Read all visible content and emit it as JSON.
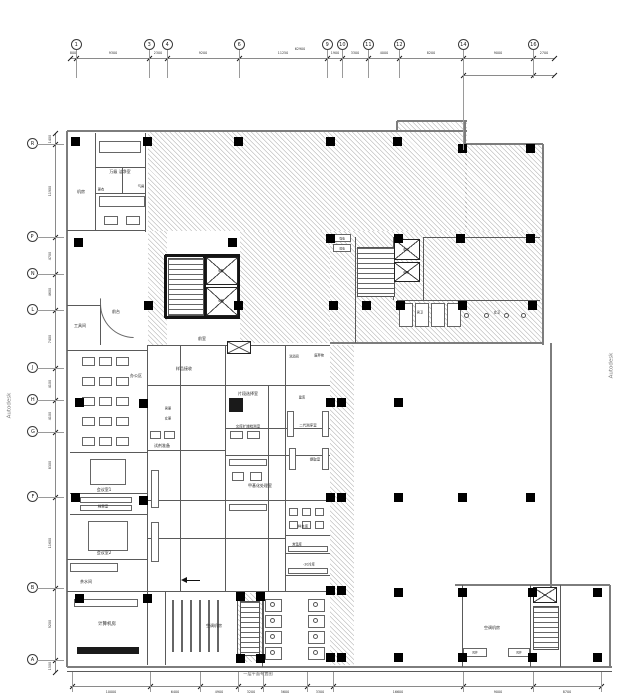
{
  "meta": {
    "watermark": "Autodesk",
    "caption": "一层平面布置图",
    "palette": {
      "wall": "#7d7d7d",
      "partition": "#5a5a5a",
      "core_wall": "#141414",
      "column": "#000000",
      "hatch": "rgba(55,55,55,0.30)",
      "background": "#ffffff"
    }
  },
  "grid": {
    "top": {
      "bubble_y": 45,
      "line_y": 58,
      "x0": 70,
      "x1": 554,
      "bubbles": [
        {
          "l": "1",
          "x": 76
        },
        {
          "l": "3",
          "x": 149
        },
        {
          "l": "4",
          "x": 167
        },
        {
          "l": "6",
          "x": 239
        },
        {
          "l": "9",
          "x": 327
        },
        {
          "l": "10",
          "x": 342
        },
        {
          "l": "11",
          "x": 368
        },
        {
          "l": "12",
          "x": 399
        },
        {
          "l": "14",
          "x": 463
        },
        {
          "l": "16",
          "x": 533
        }
      ],
      "ticks": [
        70,
        76,
        149,
        167,
        239,
        327,
        342,
        368,
        399,
        463,
        533,
        554
      ],
      "dims": [
        "800",
        "9300",
        "2300",
        "9200",
        "11250",
        "1900",
        "3300",
        "4000",
        "8200",
        "9000",
        "2700"
      ],
      "sub_line": {
        "y": 75,
        "ticks": [
          463,
          533,
          554
        ]
      },
      "overall": {
        "t": "62900",
        "x": 300,
        "y": 49
      }
    },
    "left": {
      "bubble_x": 32,
      "line_x": 55,
      "y0": 133,
      "y1": 672,
      "bubbles": [
        {
          "l": "R",
          "y": 144
        },
        {
          "l": "P",
          "y": 237
        },
        {
          "l": "N",
          "y": 274
        },
        {
          "l": "L",
          "y": 310
        },
        {
          "l": "J",
          "y": 368
        },
        {
          "l": "H",
          "y": 400
        },
        {
          "l": "G",
          "y": 432
        },
        {
          "l": "F",
          "y": 497
        },
        {
          "l": "B",
          "y": 588
        },
        {
          "l": "A",
          "y": 660
        }
      ],
      "ticks": [
        133,
        144,
        237,
        274,
        310,
        368,
        400,
        432,
        497,
        588,
        660,
        672
      ],
      "dims": [
        "1400",
        "11900",
        "4700",
        "4600",
        "7400",
        "4100",
        "4100",
        "8300",
        "11600",
        "9200",
        "1500"
      ]
    },
    "bottom": {
      "line_y": 686,
      "x0": 70,
      "x1": 601,
      "ticks": [
        72,
        150,
        200,
        238,
        263,
        307,
        333,
        463,
        533,
        601
      ],
      "dims": [
        "10000",
        "6400",
        "4900",
        "3200",
        "5600",
        "3300",
        "16600",
        "9000",
        "8700"
      ]
    }
  },
  "rooms": {
    "labels": [
      {
        "t": "机房",
        "x": 81,
        "y": 191,
        "fs": 4
      },
      {
        "t": "万级 洁净室",
        "x": 120,
        "y": 171,
        "fs": 4
      },
      {
        "t": "气闸",
        "x": 141,
        "y": 186,
        "fs": 3.2
      },
      {
        "t": "更衣",
        "x": 101,
        "y": 189,
        "fs": 3.2
      },
      {
        "t": "工具间",
        "x": 80,
        "y": 325,
        "fs": 4
      },
      {
        "t": "前台",
        "x": 116,
        "y": 311,
        "fs": 4
      },
      {
        "t": "办公区",
        "x": 136,
        "y": 375,
        "fs": 4
      },
      {
        "t": "会议室1",
        "x": 104,
        "y": 489,
        "fs": 4
      },
      {
        "t": "档案室",
        "x": 103,
        "y": 506,
        "fs": 3.5
      },
      {
        "t": "会议室2",
        "x": 104,
        "y": 552,
        "fs": 4
      },
      {
        "t": "茶水间",
        "x": 86,
        "y": 581,
        "fs": 4
      },
      {
        "t": "计算机房",
        "x": 107,
        "y": 623,
        "fs": 4.5
      },
      {
        "t": "样品接收",
        "x": 184,
        "y": 368,
        "fs": 4
      },
      {
        "t": "男更",
        "x": 168,
        "y": 408,
        "fs": 3.2
      },
      {
        "t": "女更",
        "x": 168,
        "y": 418,
        "fs": 3.2
      },
      {
        "t": "试剂准备",
        "x": 162,
        "y": 445,
        "fs": 4
      },
      {
        "t": "片段选择室",
        "x": 248,
        "y": 393,
        "fs": 4
      },
      {
        "t": "文库扩增检测室",
        "x": 248,
        "y": 426,
        "fs": 3.5
      },
      {
        "t": "甲基化处理室",
        "x": 260,
        "y": 485,
        "fs": 4
      },
      {
        "t": "洗消间",
        "x": 294,
        "y": 356,
        "fs": 3.2
      },
      {
        "t": "废弃物",
        "x": 319,
        "y": 355,
        "fs": 3.2
      },
      {
        "t": "建库",
        "x": 302,
        "y": 397,
        "fs": 3.2
      },
      {
        "t": "二代测序室",
        "x": 308,
        "y": 425,
        "fs": 3.5
      },
      {
        "t": "提取室",
        "x": 315,
        "y": 459,
        "fs": 3.5
      },
      {
        "t": "样本库",
        "x": 303,
        "y": 526,
        "fs": 3.5
      },
      {
        "t": "常温库",
        "x": 297,
        "y": 544,
        "fs": 3.2
      },
      {
        "t": "-20冷库",
        "x": 309,
        "y": 564,
        "fs": 3.2
      },
      {
        "t": "前室",
        "x": 202,
        "y": 338,
        "fs": 4
      },
      {
        "t": "电梯",
        "x": 221,
        "y": 270,
        "fs": 3
      },
      {
        "t": "电梯",
        "x": 221,
        "y": 300,
        "fs": 3
      },
      {
        "t": "电梯",
        "x": 406,
        "y": 249,
        "fs": 3
      },
      {
        "t": "电梯",
        "x": 406,
        "y": 272,
        "fs": 3
      },
      {
        "t": "男卫",
        "x": 420,
        "y": 312,
        "fs": 3.2
      },
      {
        "t": "女卫",
        "x": 497,
        "y": 312,
        "fs": 3.2
      },
      {
        "t": "强电",
        "x": 342,
        "y": 238,
        "fs": 2.8
      },
      {
        "t": "弱电",
        "x": 342,
        "y": 248,
        "fs": 2.8
      },
      {
        "t": "空调机房",
        "x": 214,
        "y": 625,
        "fs": 4
      },
      {
        "t": "空调机房",
        "x": 492,
        "y": 627,
        "fs": 4
      },
      {
        "t": "风井",
        "x": 475,
        "y": 652,
        "fs": 2.8
      },
      {
        "t": "风井",
        "x": 519,
        "y": 652,
        "fs": 2.8
      }
    ]
  },
  "layout": {
    "hatches": [
      [
        148,
        131,
        319,
        100
      ],
      [
        397,
        121,
        70,
        10
      ],
      [
        465,
        144,
        78,
        87
      ],
      [
        330,
        231,
        213,
        112
      ],
      [
        148,
        231,
        19,
        114
      ],
      [
        240,
        231,
        90,
        112
      ],
      [
        330,
        345,
        24,
        320
      ],
      [
        237,
        593,
        26,
        69
      ]
    ],
    "outlineH": [
      [
        67,
        467,
        131
      ],
      [
        397,
        467,
        121
      ],
      [
        465,
        543,
        144
      ],
      [
        330,
        543,
        343
      ],
      [
        67,
        612,
        667
      ],
      [
        455,
        610,
        585
      ]
    ],
    "outlineV": [
      [
        131,
        667,
        67
      ],
      [
        121,
        131,
        397
      ],
      [
        121,
        146,
        465
      ],
      [
        144,
        345,
        543
      ],
      [
        343,
        592,
        551
      ],
      [
        585,
        667,
        610
      ]
    ],
    "wallsH": [
      [
        67,
        145,
        230
      ],
      [
        67,
        100,
        305
      ],
      [
        67,
        147,
        350
      ],
      [
        70,
        147,
        452
      ],
      [
        70,
        147,
        493
      ],
      [
        70,
        147,
        514
      ],
      [
        67,
        147,
        559
      ],
      [
        67,
        330,
        591
      ],
      [
        95,
        145,
        167
      ],
      [
        95,
        145,
        193
      ],
      [
        147,
        330,
        345
      ],
      [
        148,
        330,
        385
      ],
      [
        148,
        225,
        450
      ],
      [
        225,
        330,
        428
      ],
      [
        225,
        330,
        455
      ],
      [
        148,
        330,
        500
      ],
      [
        285,
        330,
        535
      ],
      [
        285,
        330,
        553
      ],
      [
        285,
        330,
        575
      ],
      [
        397,
        540,
        300
      ],
      [
        423,
        540,
        237
      ],
      [
        148,
        285,
        538
      ],
      [
        67,
        612,
        671
      ]
    ],
    "wallsV": [
      [
        133,
        230,
        95
      ],
      [
        133,
        232,
        145
      ],
      [
        167,
        193,
        122
      ],
      [
        305,
        345,
        100
      ],
      [
        345,
        665,
        147
      ],
      [
        591,
        665,
        165
      ],
      [
        345,
        591,
        180
      ],
      [
        345,
        591,
        225
      ],
      [
        385,
        591,
        268
      ],
      [
        345,
        591,
        285
      ],
      [
        591,
        667,
        262
      ],
      [
        237,
        343,
        355
      ],
      [
        237,
        300,
        393
      ],
      [
        237,
        300,
        423
      ],
      [
        585,
        667,
        462
      ],
      [
        585,
        667,
        530
      ],
      [
        585,
        667,
        560
      ],
      [
        592,
        662,
        237
      ],
      [
        592,
        662,
        263
      ]
    ],
    "blackH": [
      [
        165,
        240,
        255
      ],
      [
        165,
        240,
        317
      ]
    ],
    "blackV": [
      [
        255,
        318,
        165
      ],
      [
        255,
        318,
        204
      ],
      [
        255,
        318,
        238
      ]
    ],
    "columns": [
      [
        75,
        141
      ],
      [
        147,
        141
      ],
      [
        238,
        141
      ],
      [
        330,
        141
      ],
      [
        397,
        141
      ],
      [
        462,
        148
      ],
      [
        530,
        148
      ],
      [
        78,
        242
      ],
      [
        232,
        242
      ],
      [
        330,
        238
      ],
      [
        398,
        238
      ],
      [
        460,
        238
      ],
      [
        530,
        238
      ],
      [
        148,
        305
      ],
      [
        238,
        305
      ],
      [
        333,
        305
      ],
      [
        366,
        305
      ],
      [
        400,
        305
      ],
      [
        462,
        305
      ],
      [
        532,
        305
      ],
      [
        79,
        402
      ],
      [
        143,
        403
      ],
      [
        330,
        402
      ],
      [
        341,
        402
      ],
      [
        398,
        402
      ],
      [
        75,
        497
      ],
      [
        143,
        500
      ],
      [
        330,
        497
      ],
      [
        341,
        497
      ],
      [
        398,
        497
      ],
      [
        462,
        497
      ],
      [
        530,
        497
      ],
      [
        79,
        598
      ],
      [
        147,
        598
      ],
      [
        330,
        590
      ],
      [
        341,
        590
      ],
      [
        398,
        592
      ],
      [
        462,
        592
      ],
      [
        532,
        592
      ],
      [
        597,
        592
      ],
      [
        330,
        657
      ],
      [
        341,
        657
      ],
      [
        398,
        657
      ],
      [
        462,
        657
      ],
      [
        532,
        657
      ],
      [
        597,
        657
      ],
      [
        240,
        596
      ],
      [
        260,
        596
      ],
      [
        240,
        658
      ],
      [
        260,
        658
      ]
    ],
    "xboxes": [
      [
        206,
        257,
        32,
        28
      ],
      [
        206,
        287,
        32,
        29
      ],
      [
        394,
        239,
        26,
        21
      ],
      [
        394,
        262,
        26,
        20
      ],
      [
        227,
        341,
        24,
        13
      ],
      [
        533,
        587,
        24,
        16
      ]
    ],
    "stairs": [
      [
        168,
        258,
        36,
        58
      ],
      [
        357,
        247,
        38,
        50
      ],
      [
        240,
        601,
        20,
        55
      ],
      [
        533,
        606,
        26,
        44
      ]
    ],
    "furn": [
      [
        99,
        141,
        42,
        12
      ],
      [
        99,
        196,
        46,
        11
      ],
      [
        104,
        216,
        14,
        9
      ],
      [
        126,
        216,
        14,
        9
      ],
      [
        90,
        459,
        36,
        26
      ],
      [
        88,
        521,
        40,
        30
      ],
      [
        80,
        497,
        52,
        6
      ],
      [
        80,
        505,
        52,
        6
      ],
      [
        70,
        563,
        48,
        9
      ],
      [
        74,
        599,
        64,
        8
      ],
      [
        150,
        431,
        11,
        8
      ],
      [
        164,
        431,
        11,
        8
      ],
      [
        151,
        470,
        8,
        38
      ],
      [
        151,
        522,
        8,
        40
      ],
      [
        230,
        431,
        13,
        8
      ],
      [
        247,
        431,
        13,
        8
      ],
      [
        229,
        459,
        38,
        7
      ],
      [
        229,
        504,
        38,
        7
      ],
      [
        287,
        411,
        7,
        26
      ],
      [
        322,
        411,
        7,
        26
      ],
      [
        289,
        448,
        7,
        22
      ],
      [
        322,
        448,
        7,
        22
      ],
      [
        288,
        546,
        40,
        6
      ],
      [
        288,
        568,
        40,
        6
      ],
      [
        232,
        472,
        12,
        9
      ],
      [
        250,
        472,
        12,
        9
      ],
      [
        463,
        648,
        24,
        9
      ],
      [
        508,
        648,
        22,
        9
      ],
      [
        333,
        234,
        18,
        8
      ],
      [
        333,
        244,
        18,
        8
      ]
    ],
    "filled": [
      [
        77,
        647,
        62,
        7
      ],
      [
        229,
        398,
        14,
        14
      ]
    ],
    "grids": [
      {
        "x0": 82,
        "y0": 357,
        "cols": 3,
        "rows": 5,
        "dx": 17,
        "dy": 20,
        "w": 13,
        "h": 9
      },
      {
        "x0": 289,
        "y0": 508,
        "cols": 3,
        "rows": 2,
        "dx": 13,
        "dy": 13,
        "w": 9,
        "h": 8
      },
      {
        "x0": 265,
        "y0": 599,
        "cols": 1,
        "rows": 4,
        "dx": 0,
        "dy": 16,
        "w": 17,
        "h": 13
      },
      {
        "x0": 308,
        "y0": 599,
        "cols": 1,
        "rows": 4,
        "dx": 0,
        "dy": 16,
        "w": 17,
        "h": 13
      },
      {
        "x0": 399,
        "y0": 303,
        "cols": 4,
        "rows": 1,
        "dx": 16,
        "dy": 0,
        "w": 14,
        "h": 24
      },
      {
        "x0": 172,
        "y0": 600,
        "cols": 6,
        "rows": 1,
        "dx": 9,
        "dy": 0,
        "w": 1,
        "h": 52
      }
    ],
    "dots": [
      [
        273,
        605
      ],
      [
        273,
        621
      ],
      [
        273,
        637
      ],
      [
        273,
        653
      ],
      [
        316,
        605
      ],
      [
        316,
        621
      ],
      [
        316,
        637
      ],
      [
        316,
        653
      ],
      [
        467,
        316
      ],
      [
        487,
        316
      ],
      [
        507,
        316
      ],
      [
        524,
        316
      ]
    ]
  }
}
